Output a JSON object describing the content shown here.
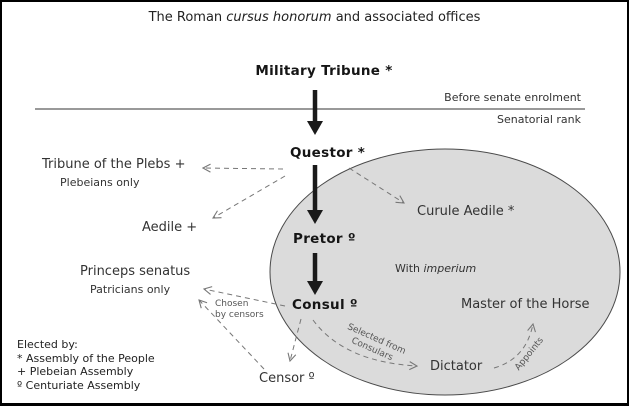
{
  "title": {
    "pre": "The Roman ",
    "italic": "cursus honorum",
    "post": " and associated offices"
  },
  "divider": {
    "above_label": "Before senate enrolment",
    "below_label": "Senatorial rank"
  },
  "offices": {
    "military_tribune": "Military Tribune *",
    "questor": "Questor *",
    "tribune_of_the_plebs": "Tribune of the Plebs +",
    "plebeians_only": "Plebeians only",
    "aedile": "Aedile +",
    "curule_aedile": "Curule Aedile *",
    "pretor": "Pretor º",
    "consul": "Consul º",
    "princeps_senatus": "Princeps senatus",
    "patricians_only": "Patricians only",
    "master_of_the_horse": "Master of the Horse",
    "dictator": "Dictator",
    "censor": "Censor º"
  },
  "ellipse": {
    "label_pre": "With ",
    "label_italic": "imperium",
    "fill": "#dbdbdb",
    "stroke": "#4a4a4a"
  },
  "edge_labels": {
    "chosen_line1": "Chosen",
    "chosen_line2": "by censors",
    "selected_line1": "Selected from",
    "selected_line2": "Consulars",
    "appoints": "Appoints"
  },
  "legend": {
    "title": "Elected by:",
    "items": [
      "* Assembly of the People",
      "+ Plebeian Assembly",
      "º Centuriate Assembly"
    ]
  },
  "colors": {
    "solid_arrow": "#1a1a1a",
    "dashed_arrow": "#777777",
    "divider_line": "#333333"
  }
}
